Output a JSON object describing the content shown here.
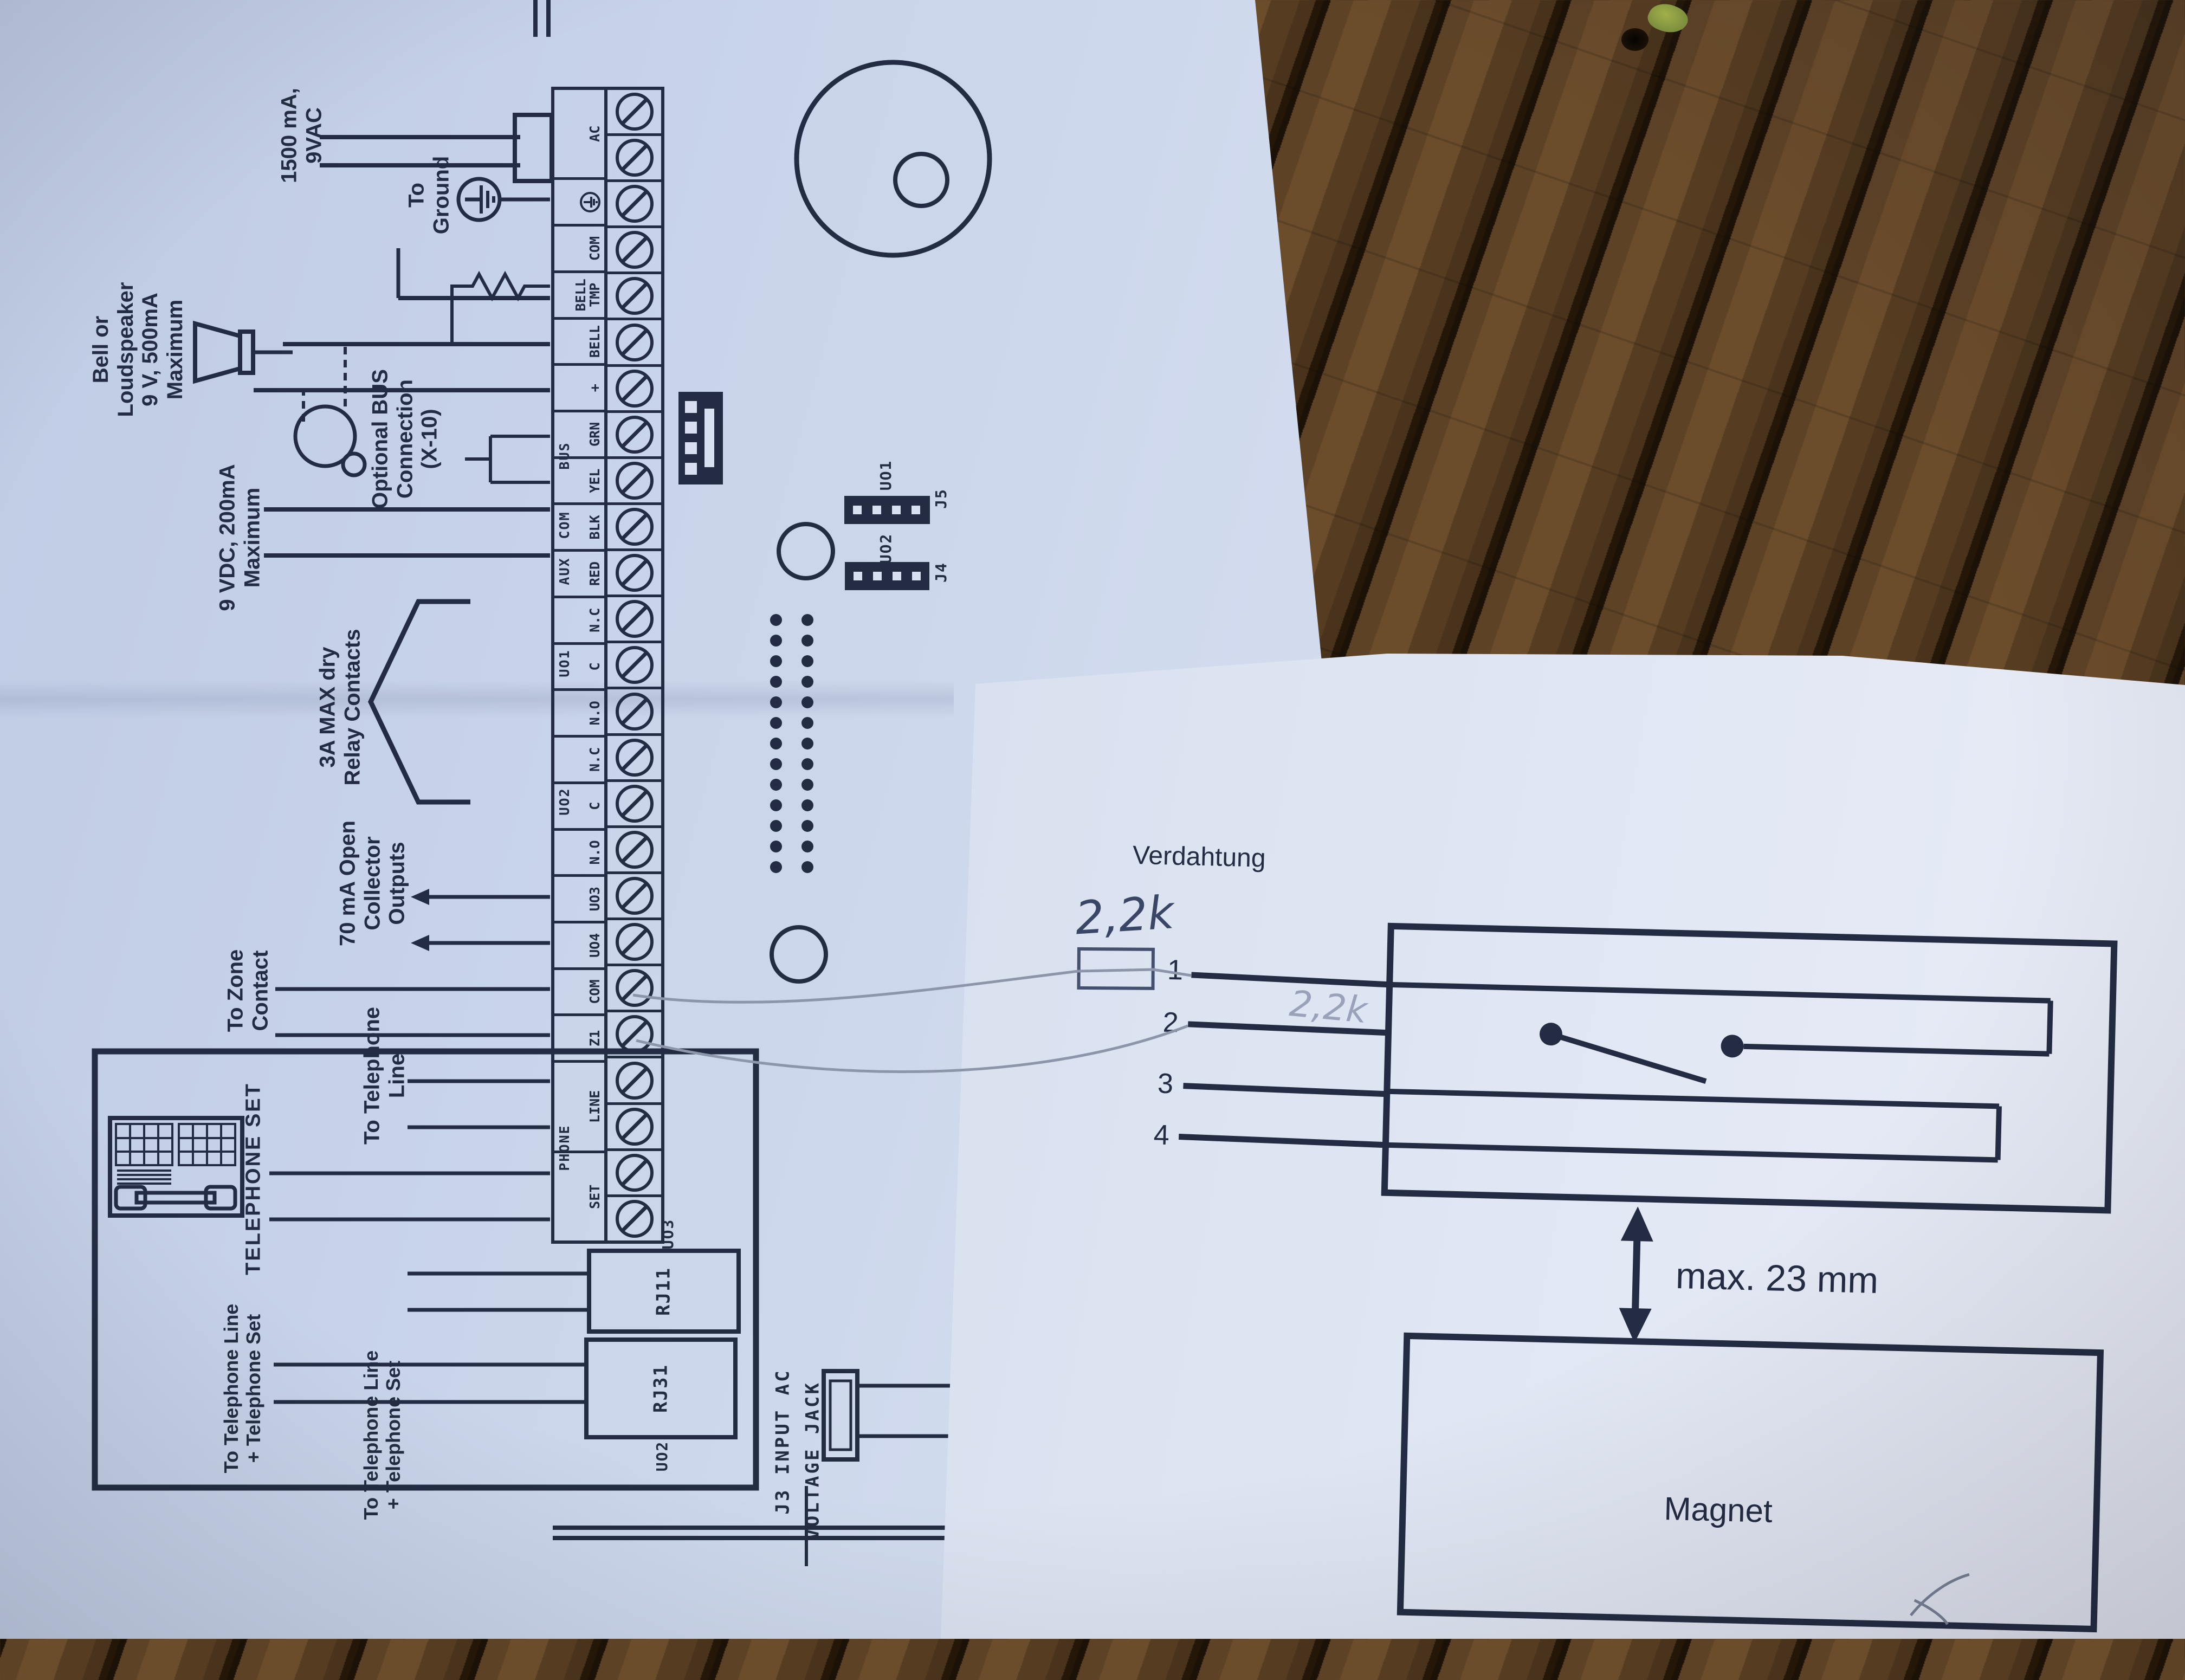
{
  "wiring_diagram": {
    "transformer_label": "1500 mA, 9VAC",
    "ground_label": "To\nGround",
    "bell_label": "Bell or\nLoudspeaker\n9 V, 500mA\nMaximum",
    "aux_label": "9 VDC, 200mA\nMaximum",
    "bus_label": "Optional BUS\nConnection\n(X-10)",
    "relay_label": "3A MAX dry\nRelay Contacts",
    "oc_label": "70 mA Open\nCollector\nOutputs",
    "zone_label": "To Zone\nContact",
    "phone_line_label": "To Telephone\nLine",
    "phone_set_label": "TELEPHONE SET",
    "rj31_wires_label": "To Telephone Line\n+ Telephone Set",
    "rj11_wires_label": "To Telephone Line\n+ Telephone Set",
    "rj11_label": "RJ11",
    "rj31_label": "RJ31",
    "uo3_ref": "UO3",
    "uo2_ref": "UO2",
    "j3_label_line1": "J3 INPUT AC",
    "j3_label_line2": "VOLTAGE JACK",
    "jumpers": {
      "uo1": "UO1",
      "j5": "J5",
      "uo2": "UO2",
      "j4": "J4"
    },
    "strip": {
      "groups": {
        "phone": "PHONE",
        "uo2": "UO2",
        "uo1": "UO1",
        "aux": "AUX",
        "com": "COM",
        "bus": "BUS"
      },
      "labels": [
        "SET",
        "LINE",
        "Z1",
        "COM",
        "UO4",
        "UO3",
        "N.O",
        "C",
        "N.C",
        "N.O",
        "C",
        "N.C",
        "RED",
        "BLK",
        "YEL",
        "GRN",
        "+",
        "BELL",
        "BELL\nTMP",
        "COM",
        "",
        "AC"
      ]
    }
  },
  "magnet_sheet": {
    "title": "Verdahtung",
    "resistor_value_pen": "2,2k",
    "resistor_value_pencil": "2,2k",
    "pin_labels": [
      "1",
      "2",
      "3",
      "4"
    ],
    "gap_label": "max. 23 mm",
    "magnet_label": "Magnet"
  }
}
